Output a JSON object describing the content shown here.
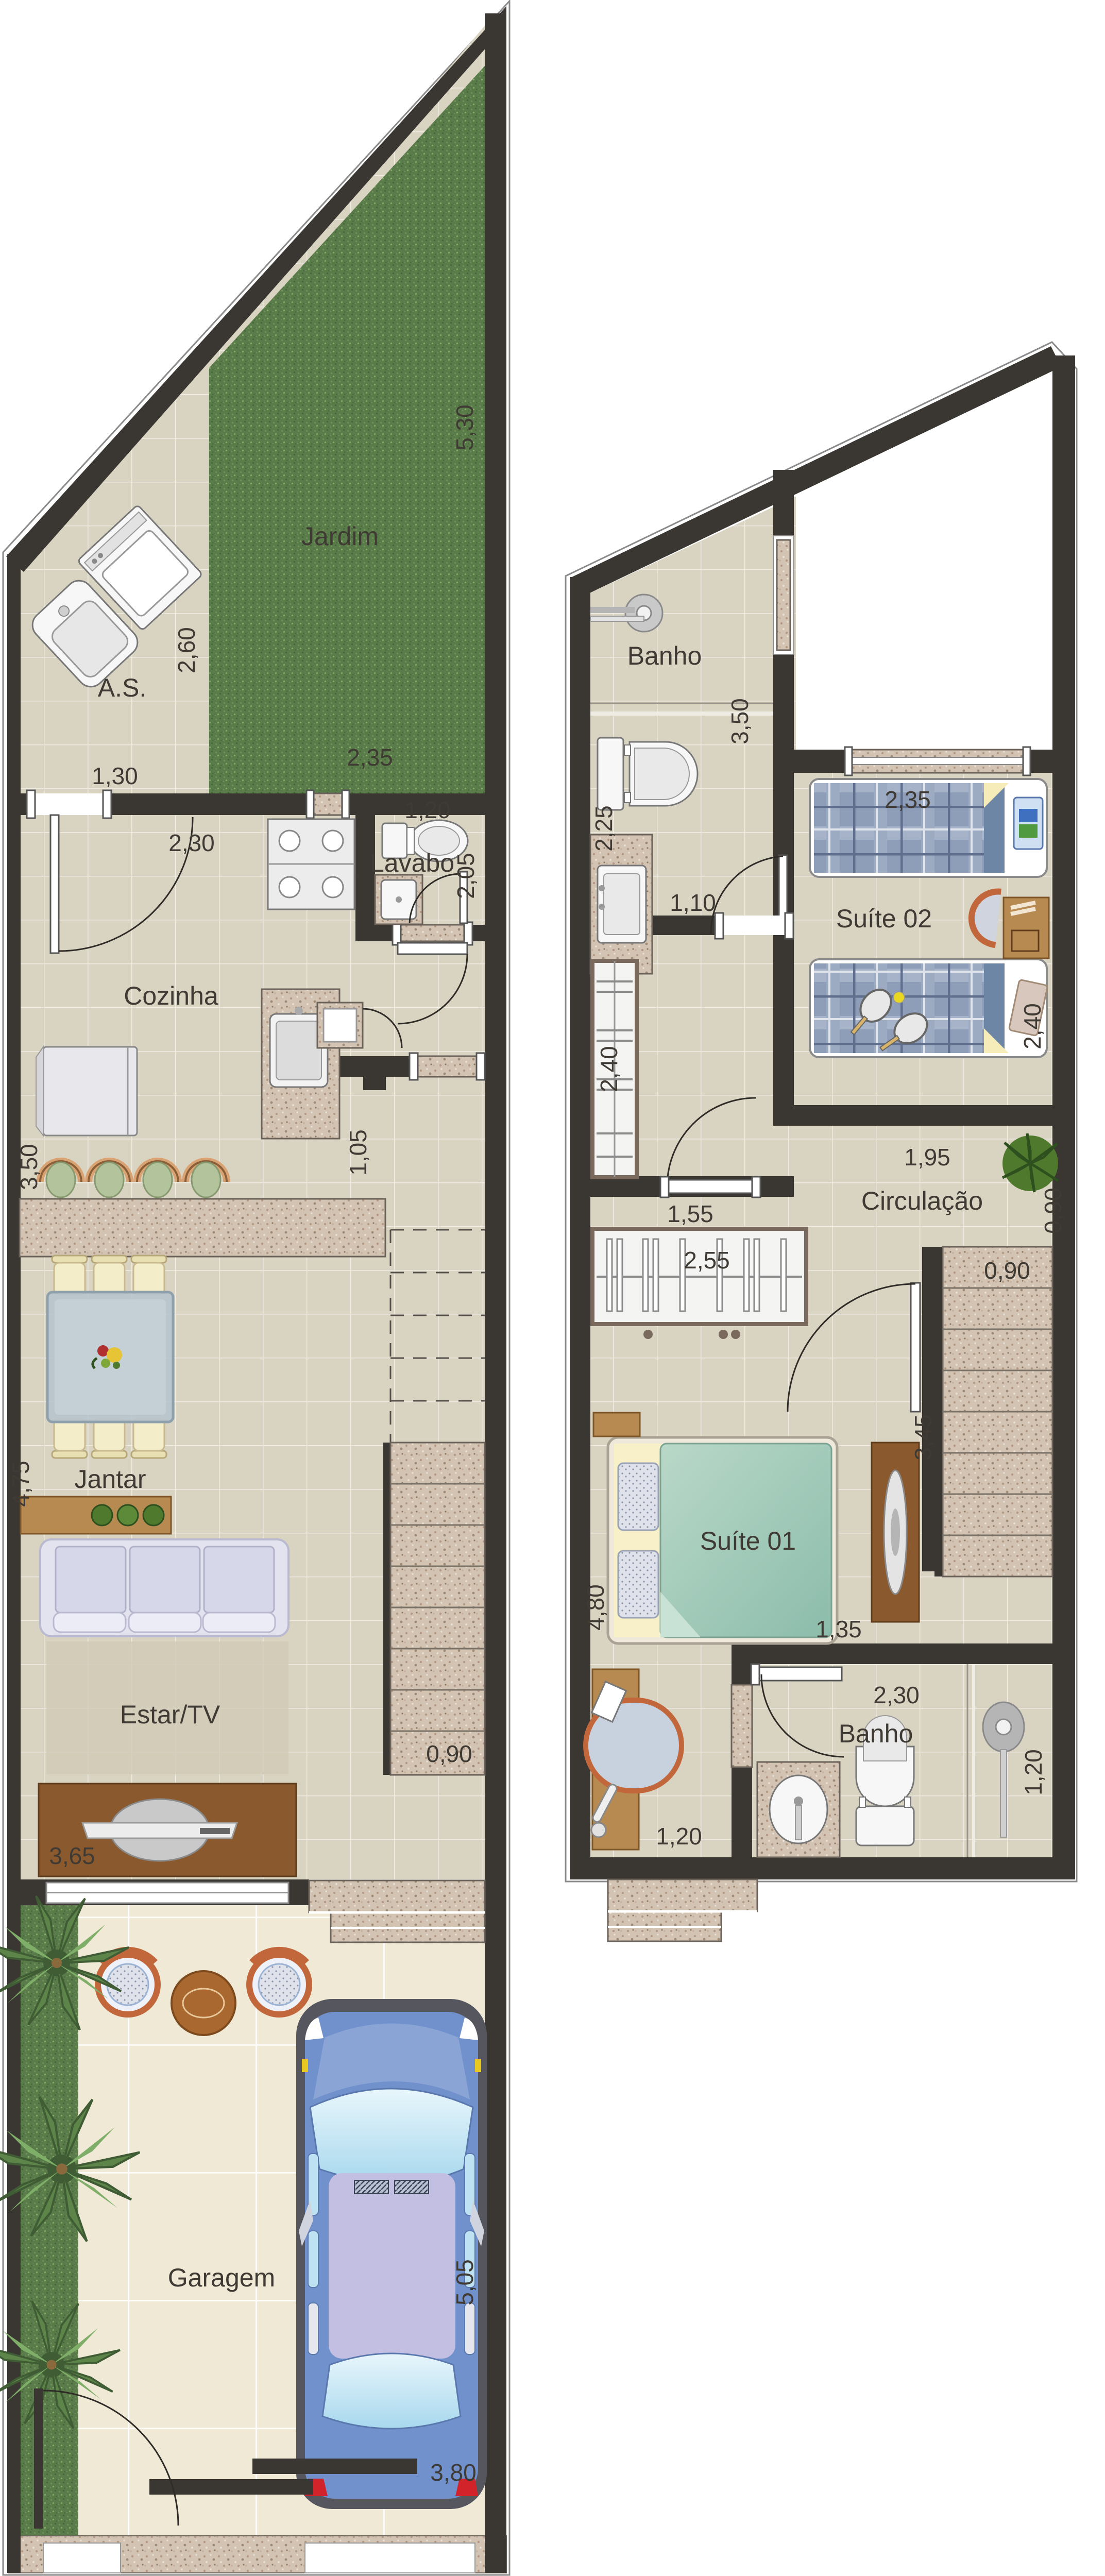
{
  "plan": {
    "type": "residential floor plan",
    "ground_floor": {
      "rooms": [
        {
          "id": "jardim",
          "label": "Jardim"
        },
        {
          "id": "area-servico",
          "label": "A.S."
        },
        {
          "id": "cozinha",
          "label": "Cozinha"
        },
        {
          "id": "lavabo",
          "label": "Lavabo"
        },
        {
          "id": "jantar",
          "label": "Jantar"
        },
        {
          "id": "estar-tv",
          "label": "Estar/TV"
        },
        {
          "id": "garagem",
          "label": "Garagem"
        }
      ],
      "dims": [
        {
          "id": "jardim-right",
          "value": "5,30"
        },
        {
          "id": "as-height",
          "value": "2,60"
        },
        {
          "id": "as-width",
          "value": "1,30"
        },
        {
          "id": "jardim-width",
          "value": "2,35"
        },
        {
          "id": "cozinha-width",
          "value": "2,30"
        },
        {
          "id": "lavabo-width",
          "value": "1,20"
        },
        {
          "id": "lavabo-height",
          "value": "2,05"
        },
        {
          "id": "cozinha-height",
          "value": "3,50"
        },
        {
          "id": "hall-width",
          "value": "1,05"
        },
        {
          "id": "jantar-height",
          "value": "4,75"
        },
        {
          "id": "stairs-width",
          "value": "0,90"
        },
        {
          "id": "estar-width",
          "value": "3,65"
        },
        {
          "id": "garagem-height",
          "value": "5,05"
        },
        {
          "id": "garagem-width",
          "value": "3,80"
        }
      ]
    },
    "upper_floor": {
      "rooms": [
        {
          "id": "banho-suite02",
          "label": "Banho"
        },
        {
          "id": "suite02",
          "label": "Suíte 02"
        },
        {
          "id": "circulacao",
          "label": "Circulação"
        },
        {
          "id": "suite01",
          "label": "Suíte 01"
        },
        {
          "id": "banho-suite01",
          "label": "Banho"
        }
      ],
      "dims": [
        {
          "id": "banho2-height",
          "value": "3,50"
        },
        {
          "id": "banho2-width",
          "value": "2,25"
        },
        {
          "id": "banho2-door",
          "value": "1,10"
        },
        {
          "id": "suite02-width",
          "value": "2,35"
        },
        {
          "id": "wardrobe-length",
          "value": "2,40"
        },
        {
          "id": "suite02-height",
          "value": "2,40"
        },
        {
          "id": "circulacao-width",
          "value": "1,95"
        },
        {
          "id": "circulacao-height",
          "value": "0,90"
        },
        {
          "id": "passage-width",
          "value": "1,55"
        },
        {
          "id": "closet-width",
          "value": "2,55"
        },
        {
          "id": "stairs-width",
          "value": "0,90"
        },
        {
          "id": "suite01-height",
          "value": "3,45"
        },
        {
          "id": "suite01-length",
          "value": "4,80"
        },
        {
          "id": "banho1-passage",
          "value": "1,35"
        },
        {
          "id": "banho1-width",
          "value": "2,30"
        },
        {
          "id": "banho1-shower",
          "value": "1,20"
        },
        {
          "id": "banho1-door",
          "value": "1,20"
        }
      ]
    }
  },
  "colors": {
    "wall": "#3a3733",
    "floor": "#d9d3c1",
    "yard": "#f0e9d6",
    "grass": "#5a7c4a",
    "granite": "#d2c3b2",
    "wood": "#b78a52",
    "glass-table": "#b9c4cd",
    "sofa": "#e3e3f0",
    "bed-plaid": "#8e9db8",
    "bed-teal": "#9dc3b2",
    "car-body": "#7191cc",
    "car-roof": "#c3bfe3",
    "chair-cream": "#f3edca",
    "rattan": "#c2673b"
  }
}
